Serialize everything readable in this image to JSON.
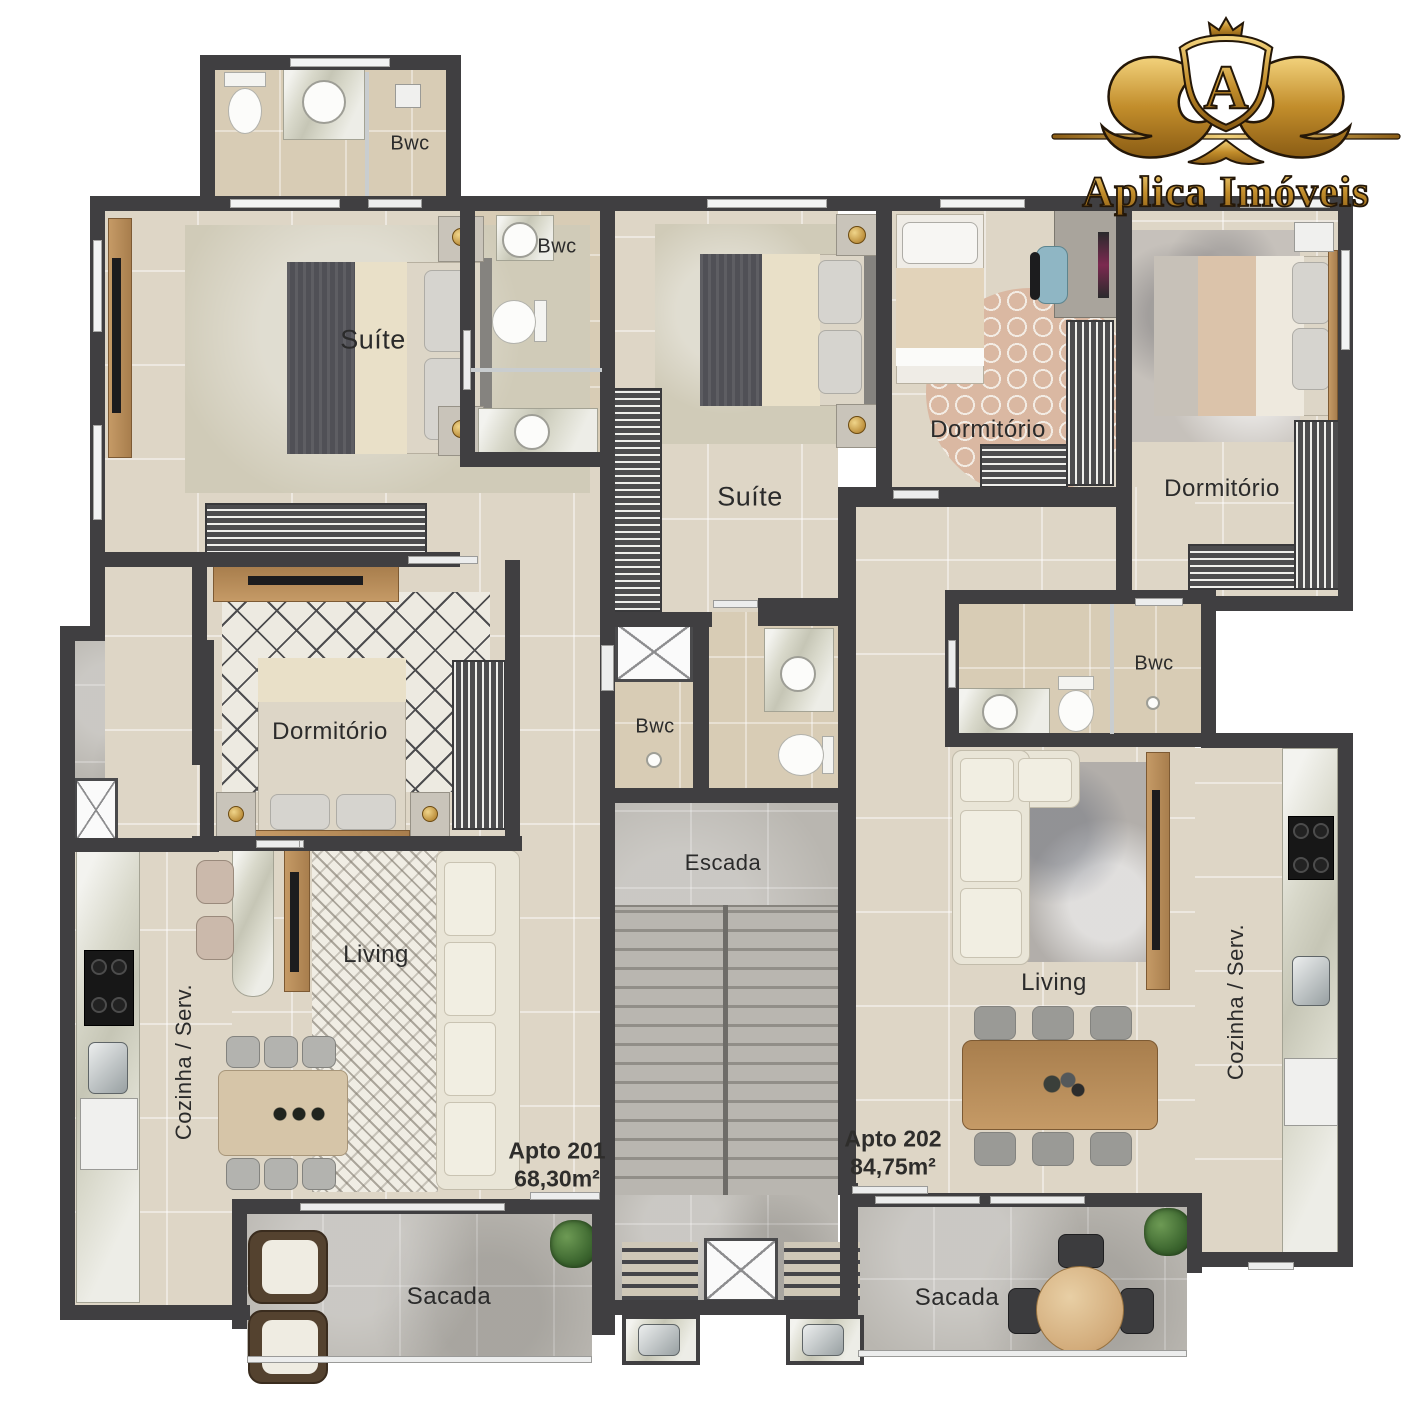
{
  "brand": {
    "name": "Aplica Imóveis",
    "monogram": "A"
  },
  "units": [
    {
      "name": "Apto 201",
      "area": "68,30m²"
    },
    {
      "name": "Apto 202",
      "area": "84,75m²"
    }
  ],
  "labels": {
    "bwc": "Bwc",
    "suite": "Suíte",
    "dormitorio": "Dormitório",
    "living": "Living",
    "cozinha": "Cozinha / Serv.",
    "escada": "Escada",
    "sacada": "Sacada"
  },
  "colors": {
    "wall": "#403f41",
    "floor": "#ded6c6",
    "bath_floor": "#d8ccb5",
    "concrete": "#b9b6b0",
    "wood": "#b68b5a",
    "gold": "#c69133",
    "background": "#ffffff"
  }
}
